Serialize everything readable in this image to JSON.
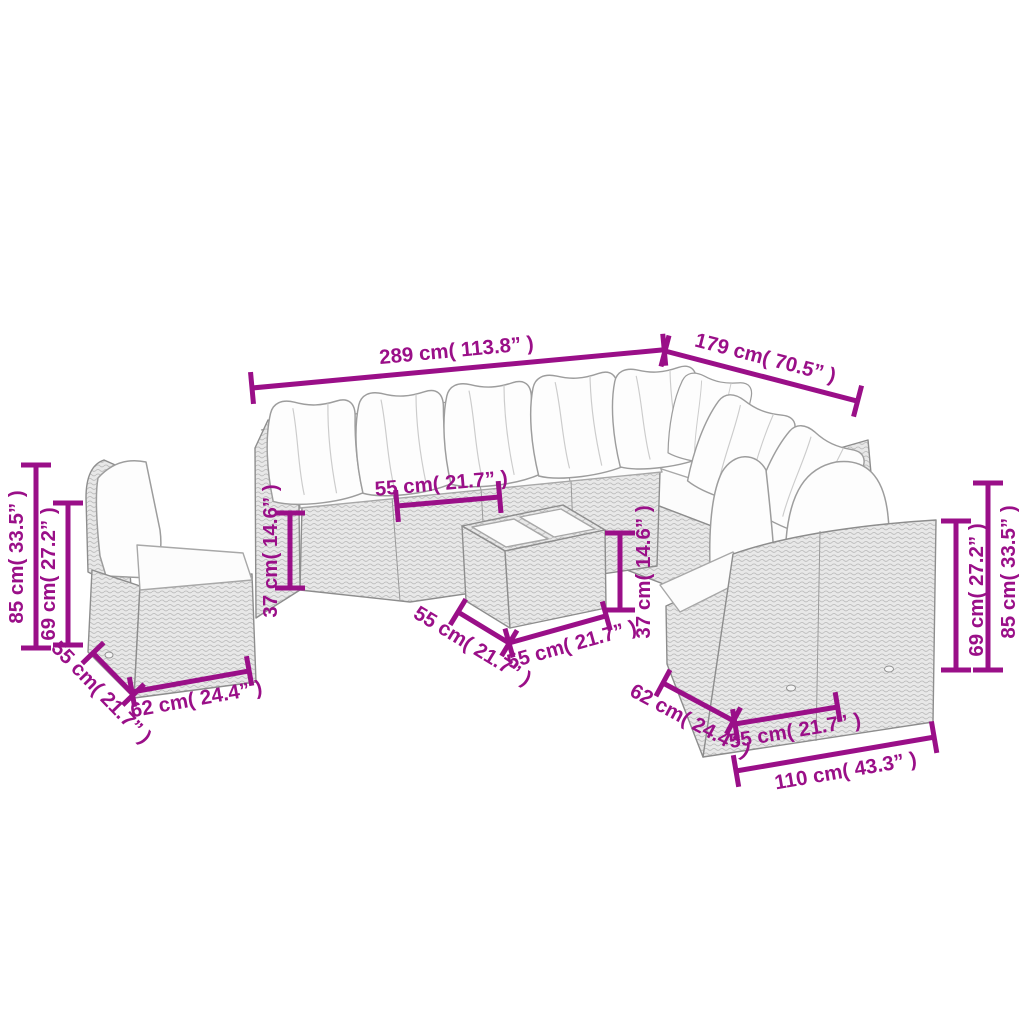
{
  "image": {
    "kind": "product-dimension-diagram",
    "subject": "garden-lounge-set-poly-rattan",
    "background": "#ffffff"
  },
  "colors": {
    "dimension_accent": "#9A0F88",
    "wicker_fill": "#e8e8e8",
    "wicker_weave": "#bdbdbd",
    "outline_gray": "#8d8d8d",
    "cushion_white": "#fcfcfc"
  },
  "furniture": {
    "corner_sofa": "corner sofa with back pillows",
    "armless_chair": "armless chair with cushions",
    "coffee_table": "coffee table with two glass tops",
    "bench": "two-seater sofa seen from behind"
  },
  "dims": {
    "sofa_total_width": {
      "label": "289 cm( 113.8” )"
    },
    "sofa_wing_length": {
      "label": "179 cm( 70.5” )"
    },
    "chair_total_height": {
      "label": "85 cm( 33.5” )"
    },
    "chair_back_height": {
      "label": "69 cm( 27.2” )"
    },
    "chair_seat_depth": {
      "label": "55 cm( 21.7” )"
    },
    "chair_width": {
      "label": "62 cm( 24.4” )"
    },
    "sofa_seat_width": {
      "label": "55 cm( 21.7” )"
    },
    "sofa_seat_height": {
      "label": "37 cm( 14.6” )"
    },
    "table_depth": {
      "label": "55 cm( 21.7” )"
    },
    "table_width": {
      "label": "55 cm( 21.7” )"
    },
    "table_height": {
      "label": "37 cm( 14.6” )"
    },
    "bench_depth": {
      "label": "62 cm( 24.4” )"
    },
    "bench_seat_width": {
      "label": "55 cm( 21.7” )"
    },
    "bench_total_width": {
      "label": "110 cm( 43.3” )"
    },
    "bench_back_height": {
      "label": "69 cm( 27.2” )"
    },
    "bench_total_height": {
      "label": "85 cm( 33.5” )"
    }
  }
}
